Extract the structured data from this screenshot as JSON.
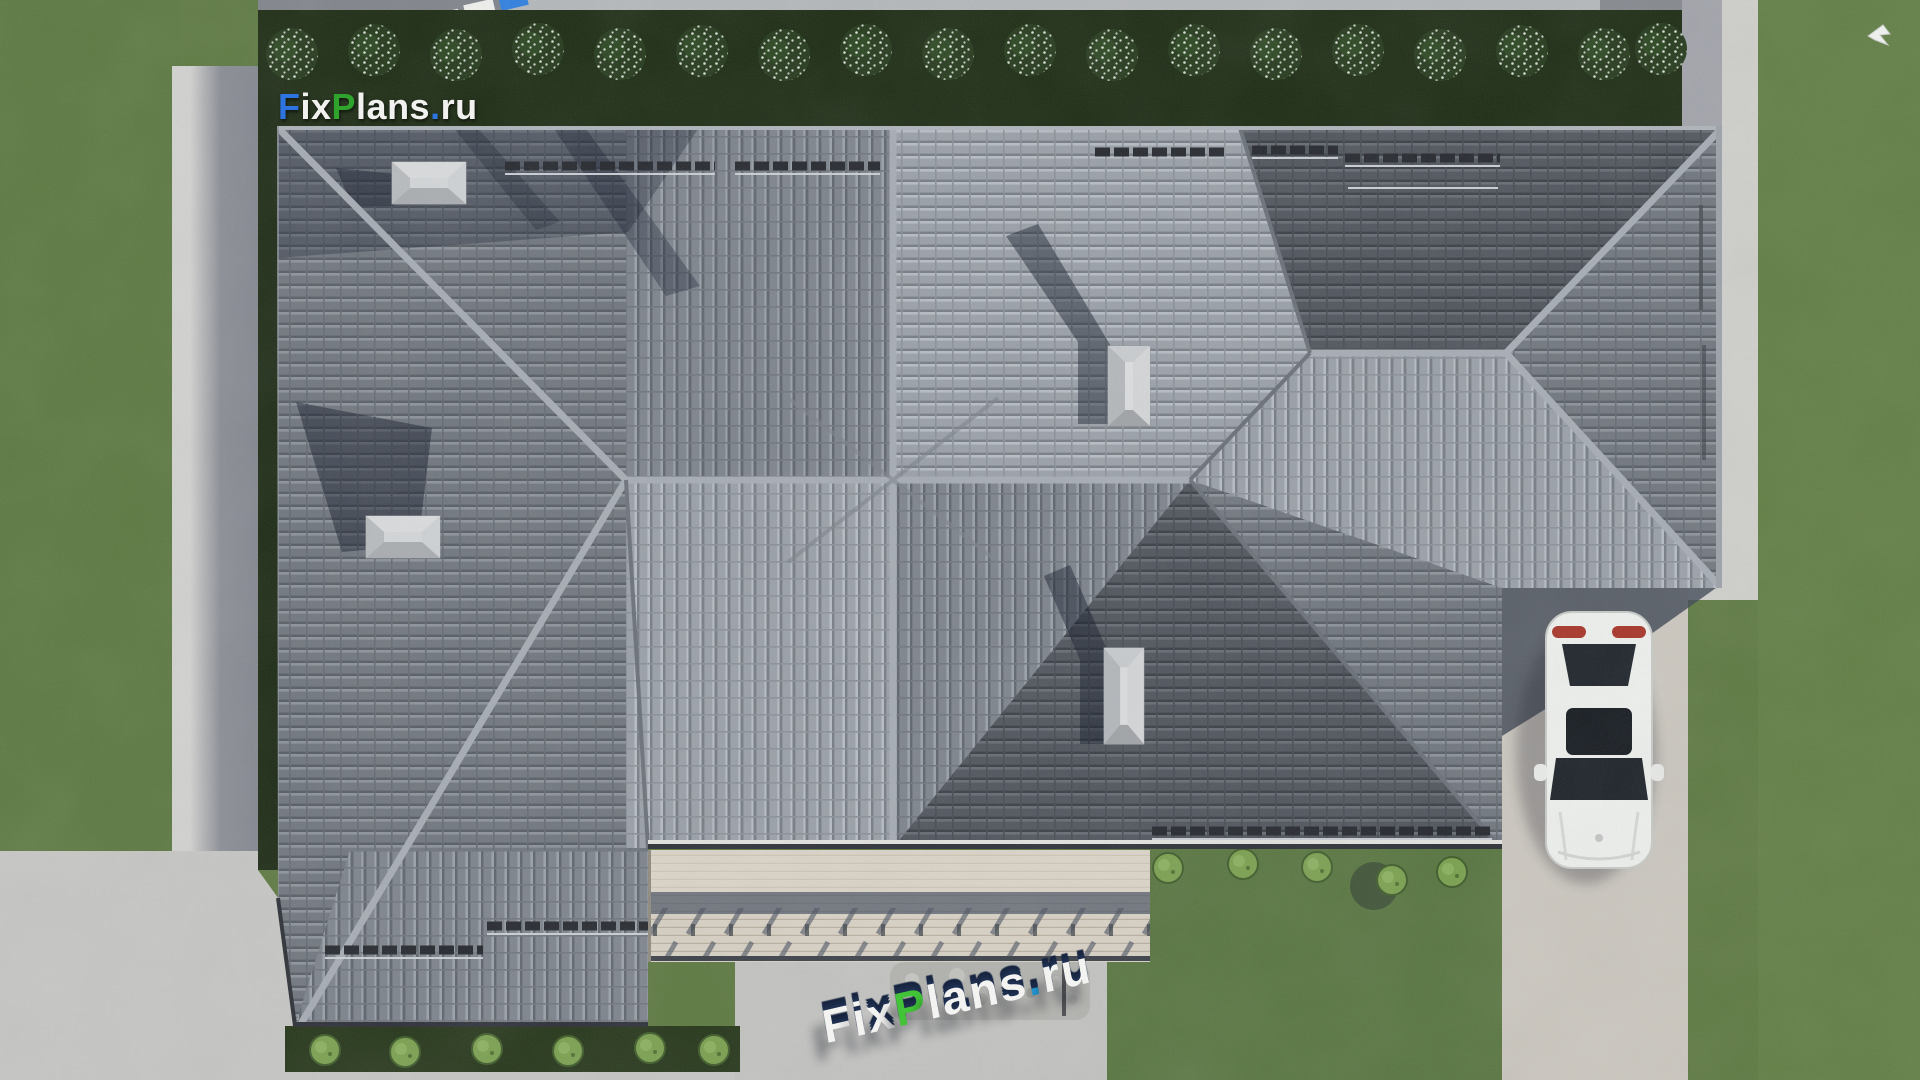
{
  "brand": {
    "f": "F",
    "ix": "ix",
    "p": "P",
    "lans": "lans",
    "dot": ".",
    "ru": "ru"
  },
  "colors": {
    "brand_blue": "#2d74e0",
    "brand_green": "#2fa32c",
    "logo_white": "#f1f1ef",
    "logo3d_green": "#43c438",
    "logo3d_blue": "#26a7e8",
    "grass": "#5d7941",
    "roof_light": "#9aa0a8",
    "roof_medium": "#70767e",
    "roof_dark": "#4f545c",
    "concrete": "#cbc7bf",
    "garden_strip": "#1b2a12"
  },
  "scene": {
    "top_shrubs": 18,
    "chimneys": 4,
    "vehicles": 1,
    "birds": 1
  }
}
